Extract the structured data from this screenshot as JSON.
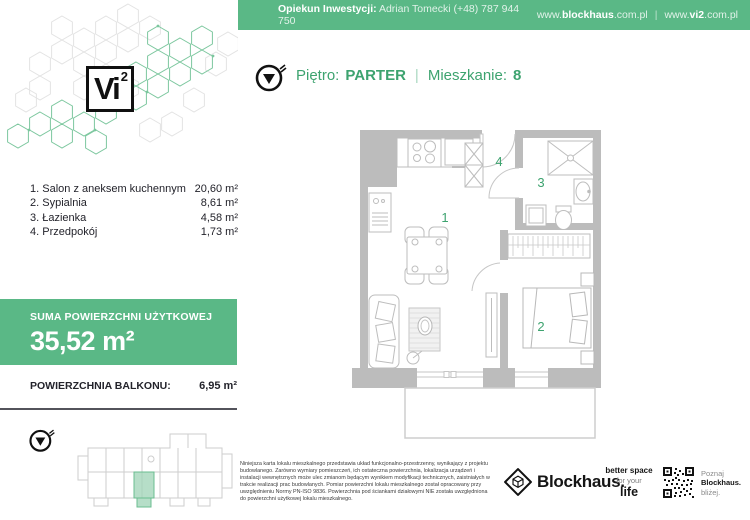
{
  "header": {
    "caretaker_label": "Opiekun Inwestycji:",
    "caretaker_value": "Adrian Tomecki (+48) 787 944 750",
    "site1_pre": "www.",
    "site1_bold": "blockhaus",
    "site1_post": ".com.pl",
    "separator": "|",
    "site2_pre": "www.",
    "site2_bold": "vi2",
    "site2_post": ".com.pl"
  },
  "logo": {
    "text": "Vi",
    "sup": "2"
  },
  "title": {
    "floor_label": "Piętro:",
    "floor_value": "PARTER",
    "separator": "|",
    "unit_label": "Mieszkanie:",
    "unit_value": "8"
  },
  "rooms": [
    {
      "num": "1.",
      "name": "Salon z aneksem kuchennym",
      "area": "20,60 m²"
    },
    {
      "num": "2.",
      "name": "Sypialnia",
      "area": "8,61 m²"
    },
    {
      "num": "3.",
      "name": "Łazienka",
      "area": "4,58 m²"
    },
    {
      "num": "4.",
      "name": "Przedpokój",
      "area": "1,73 m²"
    }
  ],
  "summary": {
    "label": "SUMA POWIERZCHNI UŻYTKOWEJ",
    "value": "35,52 m²"
  },
  "balcony": {
    "label": "POWIERZCHNIA BALKONU:",
    "value": "6,95 m²"
  },
  "floorplan": {
    "labels": {
      "room1": "1",
      "room2": "2",
      "room3": "3",
      "room4": "4"
    }
  },
  "disclaimer": "Niniejsza karta lokalu mieszkalnego przedstawia układ funkcjonalno-przestrzenny, wynikający z projektu budowlanego. Zarówno wymiary pomieszczeń, ich ostateczna powierzchnia, lokalizacja urządzeń i instalacji wewnętrznych może ulec zmianom będącym wynikiem modyfikacji technicznych, zaistniałych w trakcie realizacji prac budowlanych. Pomiar powierzchni lokalu mieszkalnego został opracowany przy uwzględnieniu Normy PN-ISO 9836. Powierzchnia pod ściankami działowymi NIE została uwzględniona do powierzchni użytkowej lokalu mieszkalnego.",
  "footer": {
    "brand": "Blockhaus.",
    "tagline_line1": "better space",
    "tagline_line2": "for your",
    "tagline_line3": "life",
    "qr_caption_line1": "Poznaj",
    "qr_caption_line2": "Blockhaus.",
    "qr_caption_line3": "bliżej."
  },
  "colors": {
    "brand_green": "#5ab886",
    "text_green": "#3da36f",
    "wall_gray": "#bcbcbc"
  }
}
